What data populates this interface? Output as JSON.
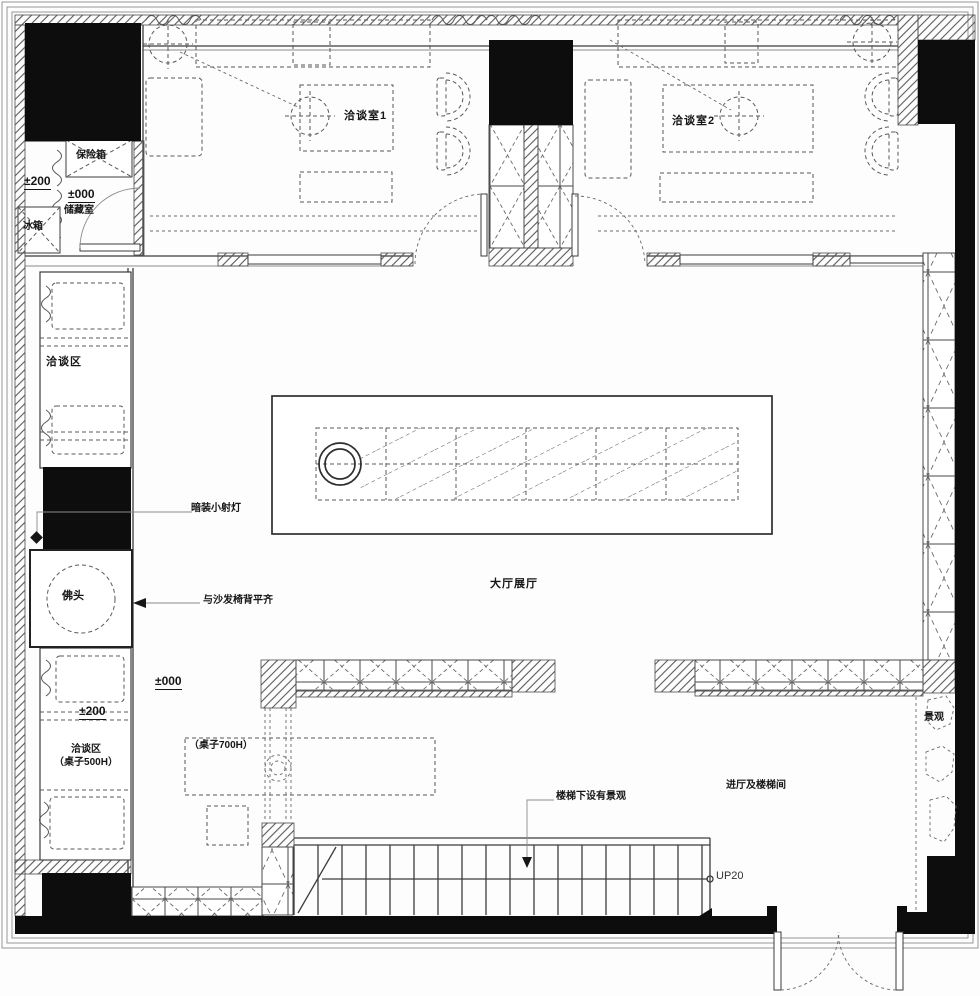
{
  "drawing": {
    "type": "architectural floor plan",
    "colors": {
      "wall": "#0d0d0d",
      "line": "#3c3c3c",
      "dash": "#585858",
      "background": "#fdfdfd"
    }
  },
  "labels": {
    "room1": "洽谈室1",
    "room2": "洽谈室2",
    "safe": "保险箱",
    "level_200_upper": "±200",
    "level_000_storage": "±000",
    "storage": "储藏室",
    "fridge": "冰箱",
    "talk_area_upper": "洽谈区",
    "spotlight": "暗装小射灯",
    "buddha": "佛头",
    "flush_sofa": "与沙发椅背平齐",
    "main_hall": "大厅展厅",
    "level_000_hall": "±000",
    "level_200_lower": "±200",
    "talk_area_lower": "洽谈区",
    "talk_area_lower_note": "（桌子500H）",
    "table_700h": "（桌子700H）",
    "stairs_landscape": "楼梯下设有景观",
    "entry_hall": "进厅及楼梯间",
    "up20": "UP20",
    "landscape": "景观"
  }
}
